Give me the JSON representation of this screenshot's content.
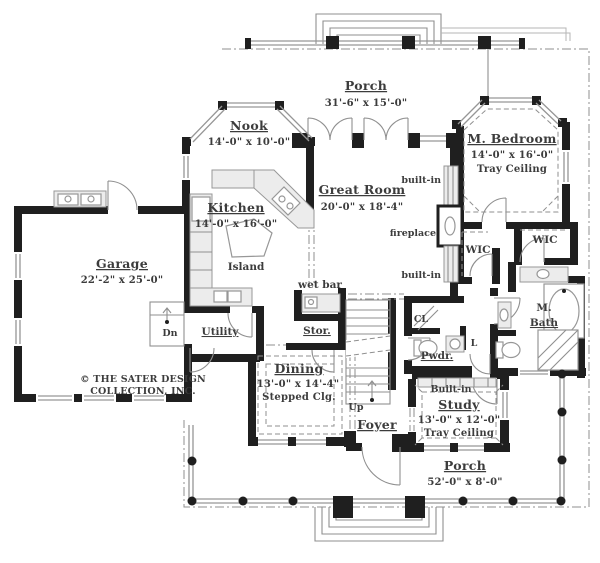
{
  "plan_title": "First floor plan",
  "copyright": {
    "line1": "© THE SATER DESIGN",
    "line2": "COLLECTION, INC."
  },
  "rooms": {
    "porch_top": {
      "name": "Porch",
      "dims": "31'-6\" x 15'-0\""
    },
    "nook": {
      "name": "Nook",
      "dims": "14'-0\" x 10'-0\""
    },
    "kitchen": {
      "name": "Kitchen",
      "dims": "14'-0\" x 16'-0\""
    },
    "great_room": {
      "name": "Great Room",
      "dims": "20'-0\" x 18'-4\""
    },
    "m_bedroom": {
      "name": "M. Bedroom",
      "dims": "14'-0\" x 16'-0\"",
      "note": "Tray Ceiling"
    },
    "garage": {
      "name": "Garage",
      "dims": "22'-2\" x 25'-0\""
    },
    "dining": {
      "name": "Dining",
      "dims": "13'-0\" x 14'-4\"",
      "note": "Stepped Clg."
    },
    "study": {
      "name": "Study",
      "dims": "13'-0\" x 12'-0\"",
      "note": "Tray Ceiling"
    },
    "porch_bottom": {
      "name": "Porch",
      "dims": "52'-0\" x 8'-0\""
    },
    "utility": {
      "name": "Utility"
    },
    "storage": {
      "name": "Stor."
    },
    "foyer": {
      "name": "Foyer"
    },
    "powder": {
      "name": "Pwdr."
    },
    "m_bath": {
      "line1": "M.",
      "line2": "Bath"
    },
    "wic_left": {
      "name": "WIC"
    },
    "wic_right": {
      "name": "WIC"
    }
  },
  "features": {
    "island": "Island",
    "wet_bar": "wet bar",
    "fireplace": "fireplace",
    "built_in_upper": "built-in",
    "built_in_lower": "built-in",
    "built_in_study": "Built-in",
    "stairs_up": "Up",
    "stairs_down": "Dn",
    "closet": "CL",
    "linen": "L"
  },
  "colors": {
    "wall": "#1f1f1f",
    "line": "#8f8f8f",
    "light_fill": "#ececec",
    "text": "#3c3c3c",
    "background": "#ffffff"
  }
}
